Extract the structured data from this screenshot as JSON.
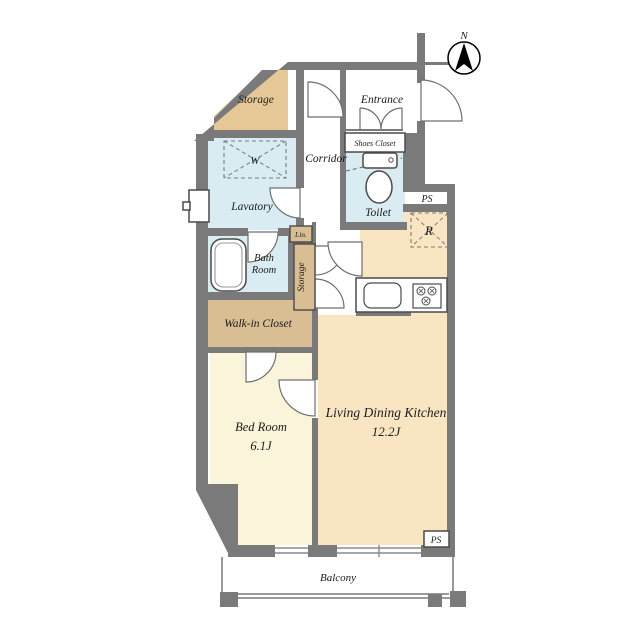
{
  "labels": {
    "compass_n": "N",
    "storage_top": "Storage",
    "entrance": "Entrance",
    "shoes_closet": "Shoes Closet",
    "corridor": "Corridor",
    "washer": "W",
    "lavatory": "Lavatory",
    "toilet": "Toilet",
    "ps_upper": "PS",
    "refrigerator": "R",
    "linen": "Lin.",
    "bath_line1": "Bath",
    "bath_line2": "Room",
    "storage_closet": "Storage",
    "walk_in_closet": "Walk-in Closet",
    "bed_room": "Bed Room",
    "bed_room_size": "6.1J",
    "ldk": "Living Dining Kitchen",
    "ldk_size": "12.2J",
    "ps_lower": "PS",
    "balcony": "Balcony"
  },
  "colors": {
    "wall": "#7a7a7a",
    "storage_tan_light": "#e6c897",
    "closet_tan": "#d8be92",
    "wet_area_blue": "#d9ecf2",
    "ldk_peach": "#fae5c3",
    "bedroom_cream": "#faf4da",
    "balcony_rail": "#9a9a9a",
    "background": "#ffffff"
  }
}
